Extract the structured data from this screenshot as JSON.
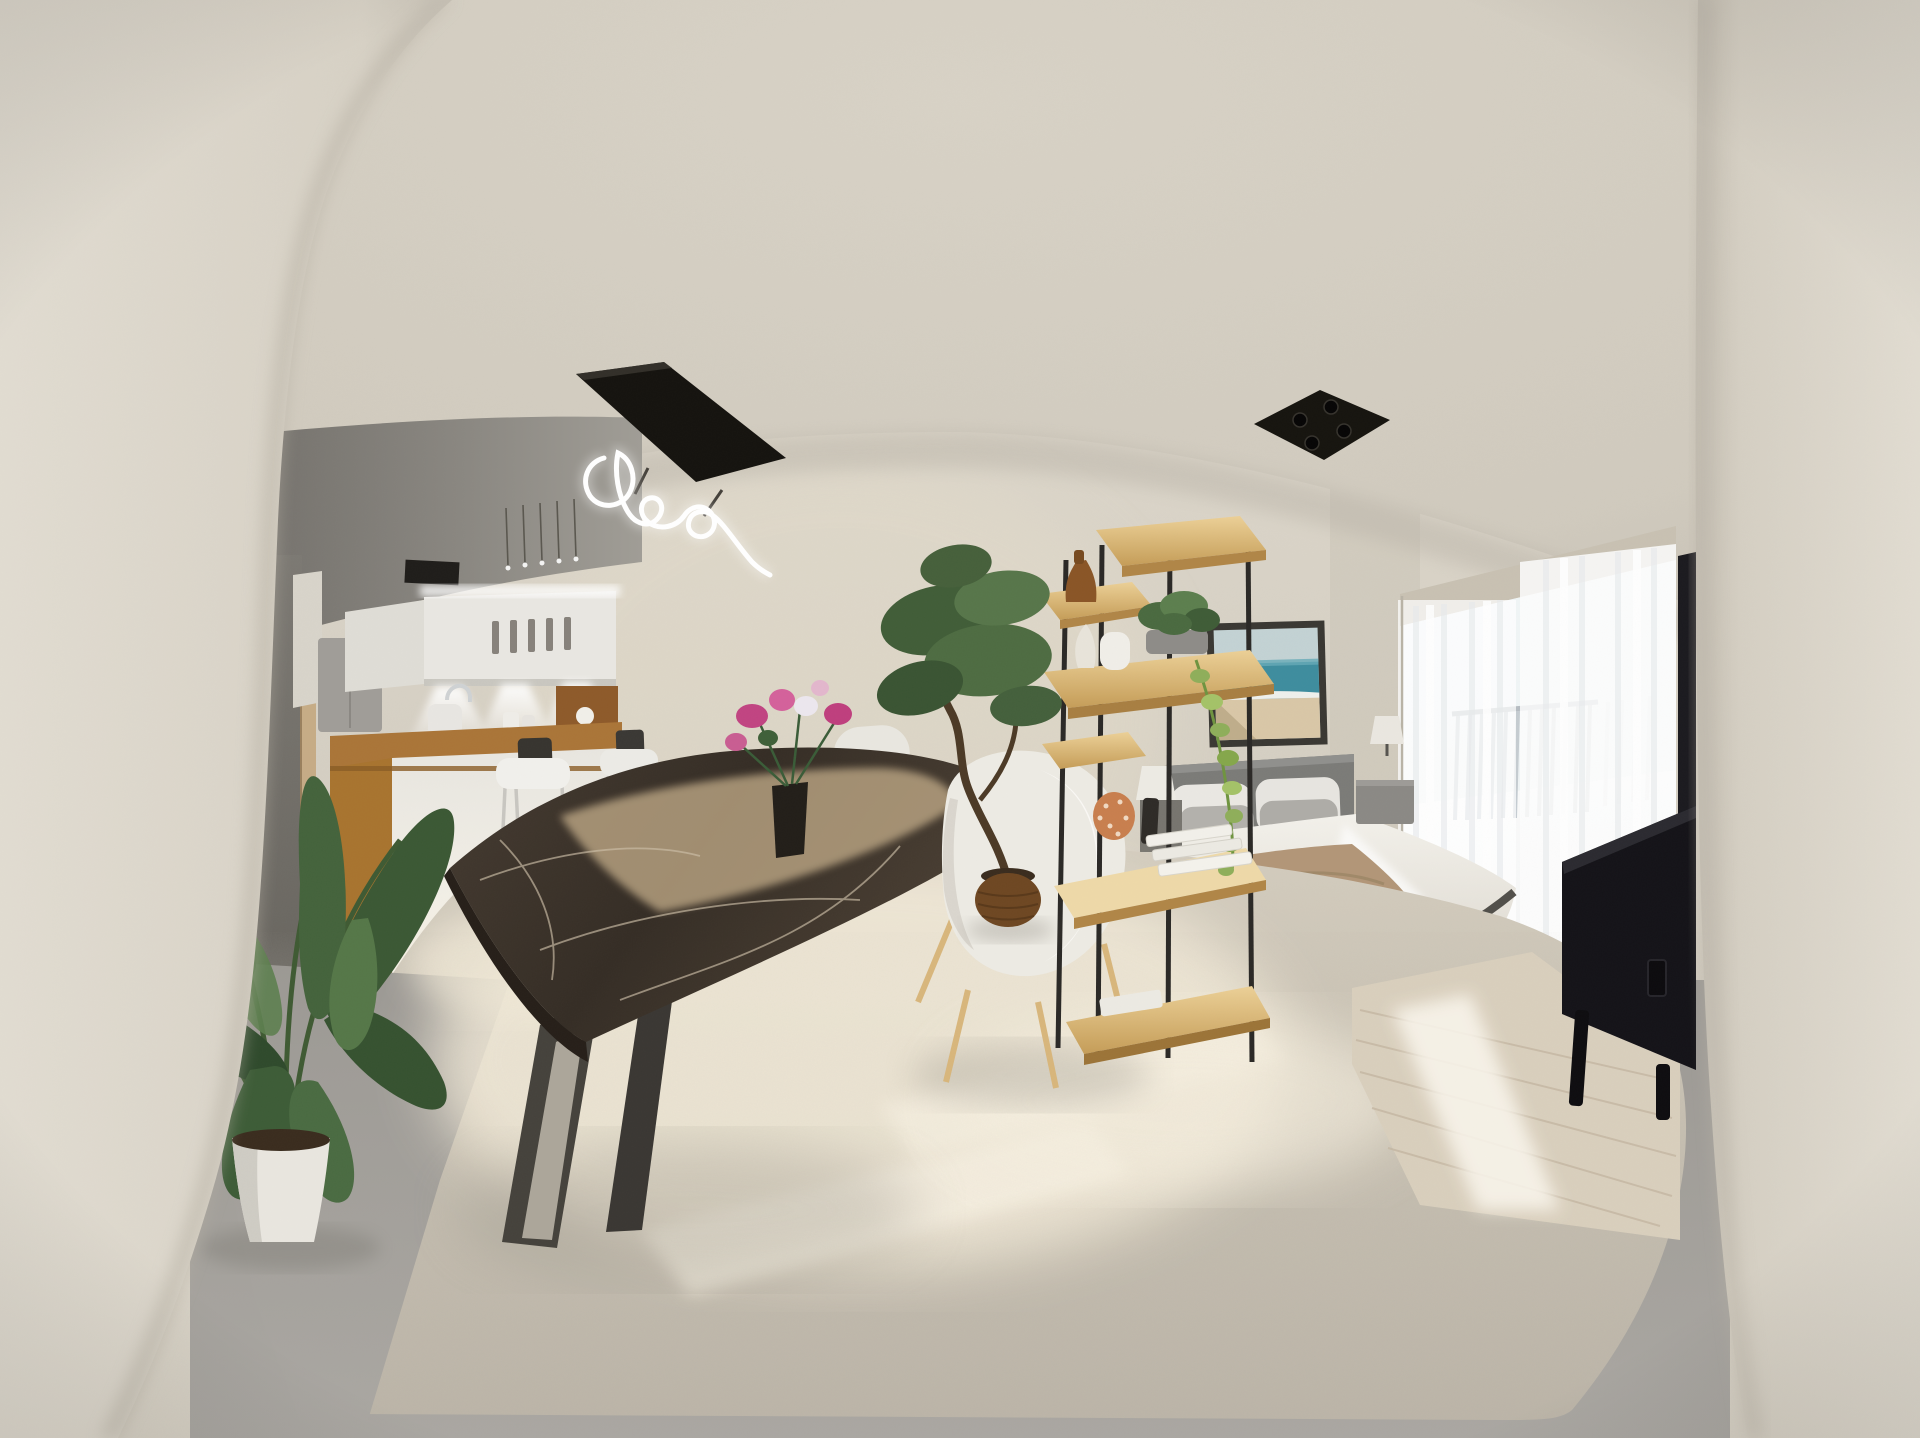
{
  "meta": {
    "scene_description": "360-degree equirectangular panorama of a furnished studio apartment: kitchen with bar counter, dark marble dining table with white chairs, open wooden shelving room divider, double bed with beach artwork, bright balcony window, black media console, large potted plants",
    "width_px": 1920,
    "height_px": 1438
  },
  "palette": {
    "wall": "#d7d1c5",
    "wallBright": "#ded8cb",
    "ceiling": "#d3cdc1",
    "recess": "#807d78",
    "pillar": "#dbd5c9",
    "pillarEdge": "#c8c2b6",
    "hallway": "#716e69",
    "fridge": "#a09d98",
    "cabinet": "#e9e7e2",
    "cabinetSide": "#dddbd4",
    "handle": "#87827b",
    "counterWood": "#aa7538",
    "backsplashWood": "#8e5a2a",
    "islandFace": "#efeee9",
    "islandWood": "#a8742f",
    "stoolSeat": "#f1f0ec",
    "stoolBack": "#37342f",
    "stoolLeg": "#c8c6c1",
    "neonPanel": "#15130f",
    "neonTube": "#ffffff",
    "tableTop": "#3d342b",
    "tableEdge": "#261f19",
    "tableLeg": "#45423c",
    "sunPatch": "#c5ae8a",
    "chairShell": "#ecebe4",
    "chairWood": "#d8b67c",
    "flowerPink": "#c14482",
    "flowerWhite": "#ece7ee",
    "vaseDark": "#221e19",
    "shelfWood": "#d9b470",
    "shelfEdge": "#b08647",
    "postBlack": "#2b2926",
    "amberVase": "#8a5526",
    "whiteVase": "#f0eee8",
    "plantDark": "#324c2d",
    "plantMid": "#3f5c37",
    "plantLight": "#5d7f4f",
    "ivyGreen": "#8fae5a",
    "coralOrange": "#c87f4e",
    "paperWhite": "#f2f0ea",
    "bonsaiPot": "#6e4722",
    "headboard": "#7b7b78",
    "pillowWhite": "#eae8e3",
    "pillowGray": "#b3b1ac",
    "duvet": "#efece6",
    "throwBeige": "#b29678",
    "bedFrame": "#514f4a",
    "rug": "#dbd3c2",
    "nightstand": "#8b8985",
    "lampShade": "#eae7e0",
    "artFrame": "#3a3833",
    "artSky": "#c3d2d4",
    "artSea": "#3e8d9e",
    "artSand": "#d9c7a7",
    "valance": "#c8c1b2",
    "windowGlow": "#fbfbfa",
    "railing": "#c3cad0",
    "woodFloor": "#d9cfbd",
    "sunStreak": "#faf4e6",
    "carpet": "#c8c1b3",
    "grayFloor": "#a5a29c",
    "console": "#141318",
    "tvBlack": "#1b1a1f",
    "lampBlack": "#16140f",
    "potWhite": "#e9e6df",
    "soil": "#3a2c1e"
  },
  "scene_objects": [
    "left-wall-pillar",
    "right-wall-pillar",
    "ceiling",
    "kitchen-ceiling-recess",
    "neon-chandelier",
    "bedroom-ceiling-lamp",
    "kitchen-cabinets",
    "under-cabinet-lights",
    "kitchen-counter",
    "bar-stools",
    "refrigerator",
    "hallway",
    "dining-table",
    "dining-chairs",
    "flower-vase",
    "shelving-divider",
    "divider-decor",
    "bonsai-plant",
    "large-floor-plant",
    "bed",
    "headboard",
    "pillows",
    "throw-blanket",
    "wall-artwork",
    "nightstand",
    "table-lamps",
    "balcony-window",
    "sheer-curtains",
    "balcony-railing",
    "media-console",
    "tv-edge",
    "wood-floor",
    "carpet",
    "sunlight-pools"
  ]
}
